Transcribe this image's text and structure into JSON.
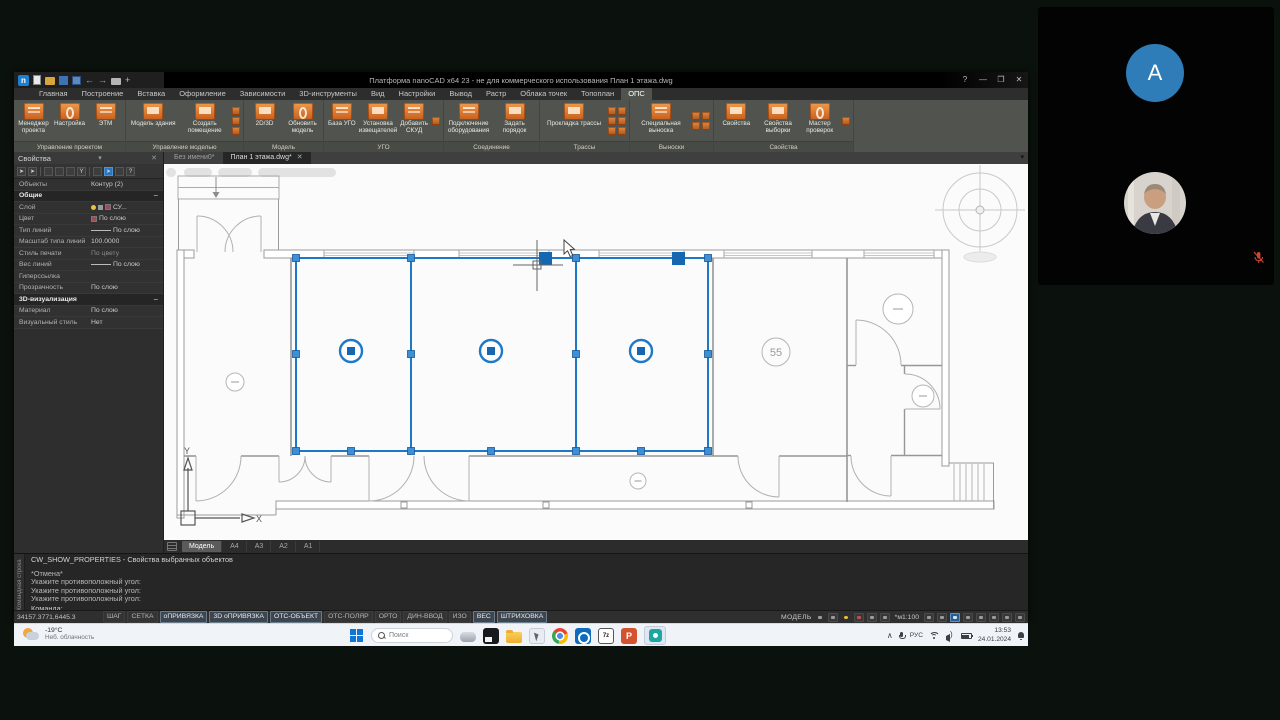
{
  "window": {
    "title": "Платформа nanoCAD x64 23 - не для коммерческого использования План 1 этажа.dwg",
    "help_glyph": "?",
    "minimize_glyph": "—",
    "maximize_glyph": "❐",
    "close_glyph": "✕"
  },
  "ribbon": {
    "tabs": [
      "Главная",
      "Построение",
      "Вставка",
      "Оформление",
      "Зависимости",
      "3D-инструменты",
      "Вид",
      "Настройки",
      "Вывод",
      "Растр",
      "Облака точек",
      "Топоплан",
      "ОПС"
    ],
    "active_tab": "ОПС",
    "groups": [
      {
        "label": "Управление проектом",
        "buttons": [
          "Менеджер проекта",
          "Настройка",
          "ЭТМ"
        ]
      },
      {
        "label": "Управление моделью",
        "buttons": [
          "Модель здания",
          "Создать помещение"
        ]
      },
      {
        "label": "Модель",
        "buttons": [
          "2D/3D",
          "Обновить модель"
        ]
      },
      {
        "label": "УГО",
        "buttons": [
          "База УГО",
          "Установка извещателей",
          "Добавить СКУД"
        ]
      },
      {
        "label": "Соединение",
        "buttons": [
          "Подключение оборудования",
          "Задать порядок"
        ]
      },
      {
        "label": "Трассы",
        "buttons": [
          "Прокладка трассы"
        ]
      },
      {
        "label": "Выноски",
        "buttons": [
          "Специальная выноска"
        ]
      },
      {
        "label": "Свойства",
        "buttons": [
          "Свойства",
          "Свойства выборки",
          "Мастер проверок"
        ]
      }
    ]
  },
  "documents": {
    "tabs": [
      {
        "label": "Без имени0*",
        "active": false
      },
      {
        "label": "План 1 этажа.dwg*",
        "active": true,
        "close_glyph": "✕"
      }
    ]
  },
  "properties": {
    "title": "Свойства",
    "help_glyph": "?",
    "rows": [
      {
        "label": "Объекты",
        "value": "Контур (2)"
      },
      {
        "label": "Общие",
        "section": true,
        "collapse": "−"
      },
      {
        "label": "Слой",
        "value": "СУ..."
      },
      {
        "label": "Цвет",
        "value": "По слою"
      },
      {
        "label": "Тип линий",
        "value": "По слою"
      },
      {
        "label": "Масштаб типа линий",
        "value": "100.0000"
      },
      {
        "label": "Стиль печати",
        "value": "По цвету"
      },
      {
        "label": "Вес линий",
        "value": "По слою"
      },
      {
        "label": "Гиперссылка",
        "value": ""
      },
      {
        "label": "Прозрачность",
        "value": "По слою"
      },
      {
        "label": "3D-визуализация",
        "section": true,
        "collapse": "−"
      },
      {
        "label": "Материал",
        "value": "По слою"
      },
      {
        "label": "Визуальный стиль",
        "value": "Нет"
      }
    ]
  },
  "canvas": {
    "room_number": "55",
    "axis_x": "X",
    "axis_y": "Y"
  },
  "layout_tabs": [
    {
      "label": "Модель",
      "active": true
    },
    {
      "label": "А4",
      "active": false
    },
    {
      "label": "А3",
      "active": false
    },
    {
      "label": "А2",
      "active": false
    },
    {
      "label": "А1",
      "active": false
    }
  ],
  "command_line": {
    "panel_tab": "Командная строка",
    "history": [
      "CW_SHOW_PROPERTIES - Свойства выбранных объектов",
      "*Отмена*",
      "Укажите противоположный угол:",
      "Укажите противоположный угол:",
      "Укажите противоположный угол:"
    ],
    "prompt": "Команда:"
  },
  "status_bar": {
    "coordinates": "34157.3771,6445.3",
    "toggles": [
      {
        "label": "ШАГ",
        "active": false
      },
      {
        "label": "СЕТКА",
        "active": false
      },
      {
        "label": "оПРИВЯЗКА",
        "active": true
      },
      {
        "label": "3D оПРИВЯЗКА",
        "active": true
      },
      {
        "label": "ОТС-ОБЪЕКТ",
        "active": true
      },
      {
        "label": "ОТС-ПОЛЯР",
        "active": false
      },
      {
        "label": "ОРТО",
        "active": false
      },
      {
        "label": "ДИН-ВВОД",
        "active": false
      },
      {
        "label": "ИЗО",
        "active": false
      },
      {
        "label": "ВЕС",
        "active": true
      },
      {
        "label": "ШТРИХОВКА",
        "active": true
      }
    ],
    "space_label": "МОДЕЛЬ",
    "scale": "*м1:100"
  },
  "taskbar": {
    "weather": {
      "temperature": "-19°C",
      "condition": "Неб. облачность"
    },
    "search_placeholder": "Поиск",
    "seven_zip_label": "7z",
    "powerpoint_letter": "P",
    "tray": {
      "language": "РУС",
      "time": "13:53",
      "date": "24.01.2024"
    }
  },
  "video_call": {
    "participant_initial": "A"
  }
}
